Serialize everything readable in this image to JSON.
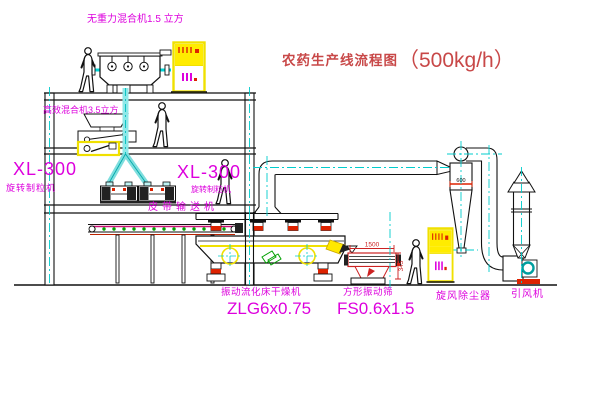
{
  "title": {
    "text": "农药生产线流程图",
    "capacity": "（500kg/h）"
  },
  "labels": {
    "gravity_mixer": "无重力混合机1.5 立方",
    "high_eff_mixer": "高效混合机3.5立方",
    "granulator_left_model": "XL-300",
    "granulator_left_name": "旋转制粒机",
    "granulator_mid_model": "XL-300",
    "granulator_mid_name": "旋转制粒机",
    "belt_conveyor": "皮带输送机",
    "dryer_name": "振动流化床干燥机",
    "dryer_model": "ZLG6x0.75",
    "screen_name": "方形振动筛",
    "screen_model": "FS0.6x1.5",
    "cyclone": "旋风除尘器",
    "fan": "引风机"
  },
  "dimensions": {
    "screen_length": "1500",
    "screen_height": "345",
    "cyclone_note": "600"
  },
  "colors": {
    "label_magenta": "#dd00dd",
    "title_red": "#c84848",
    "line_black": "#1a1a1a",
    "centerline_cyan": "#00cccc",
    "cabinet_yellow": "#f0e000",
    "alert_red": "#dd2200"
  }
}
